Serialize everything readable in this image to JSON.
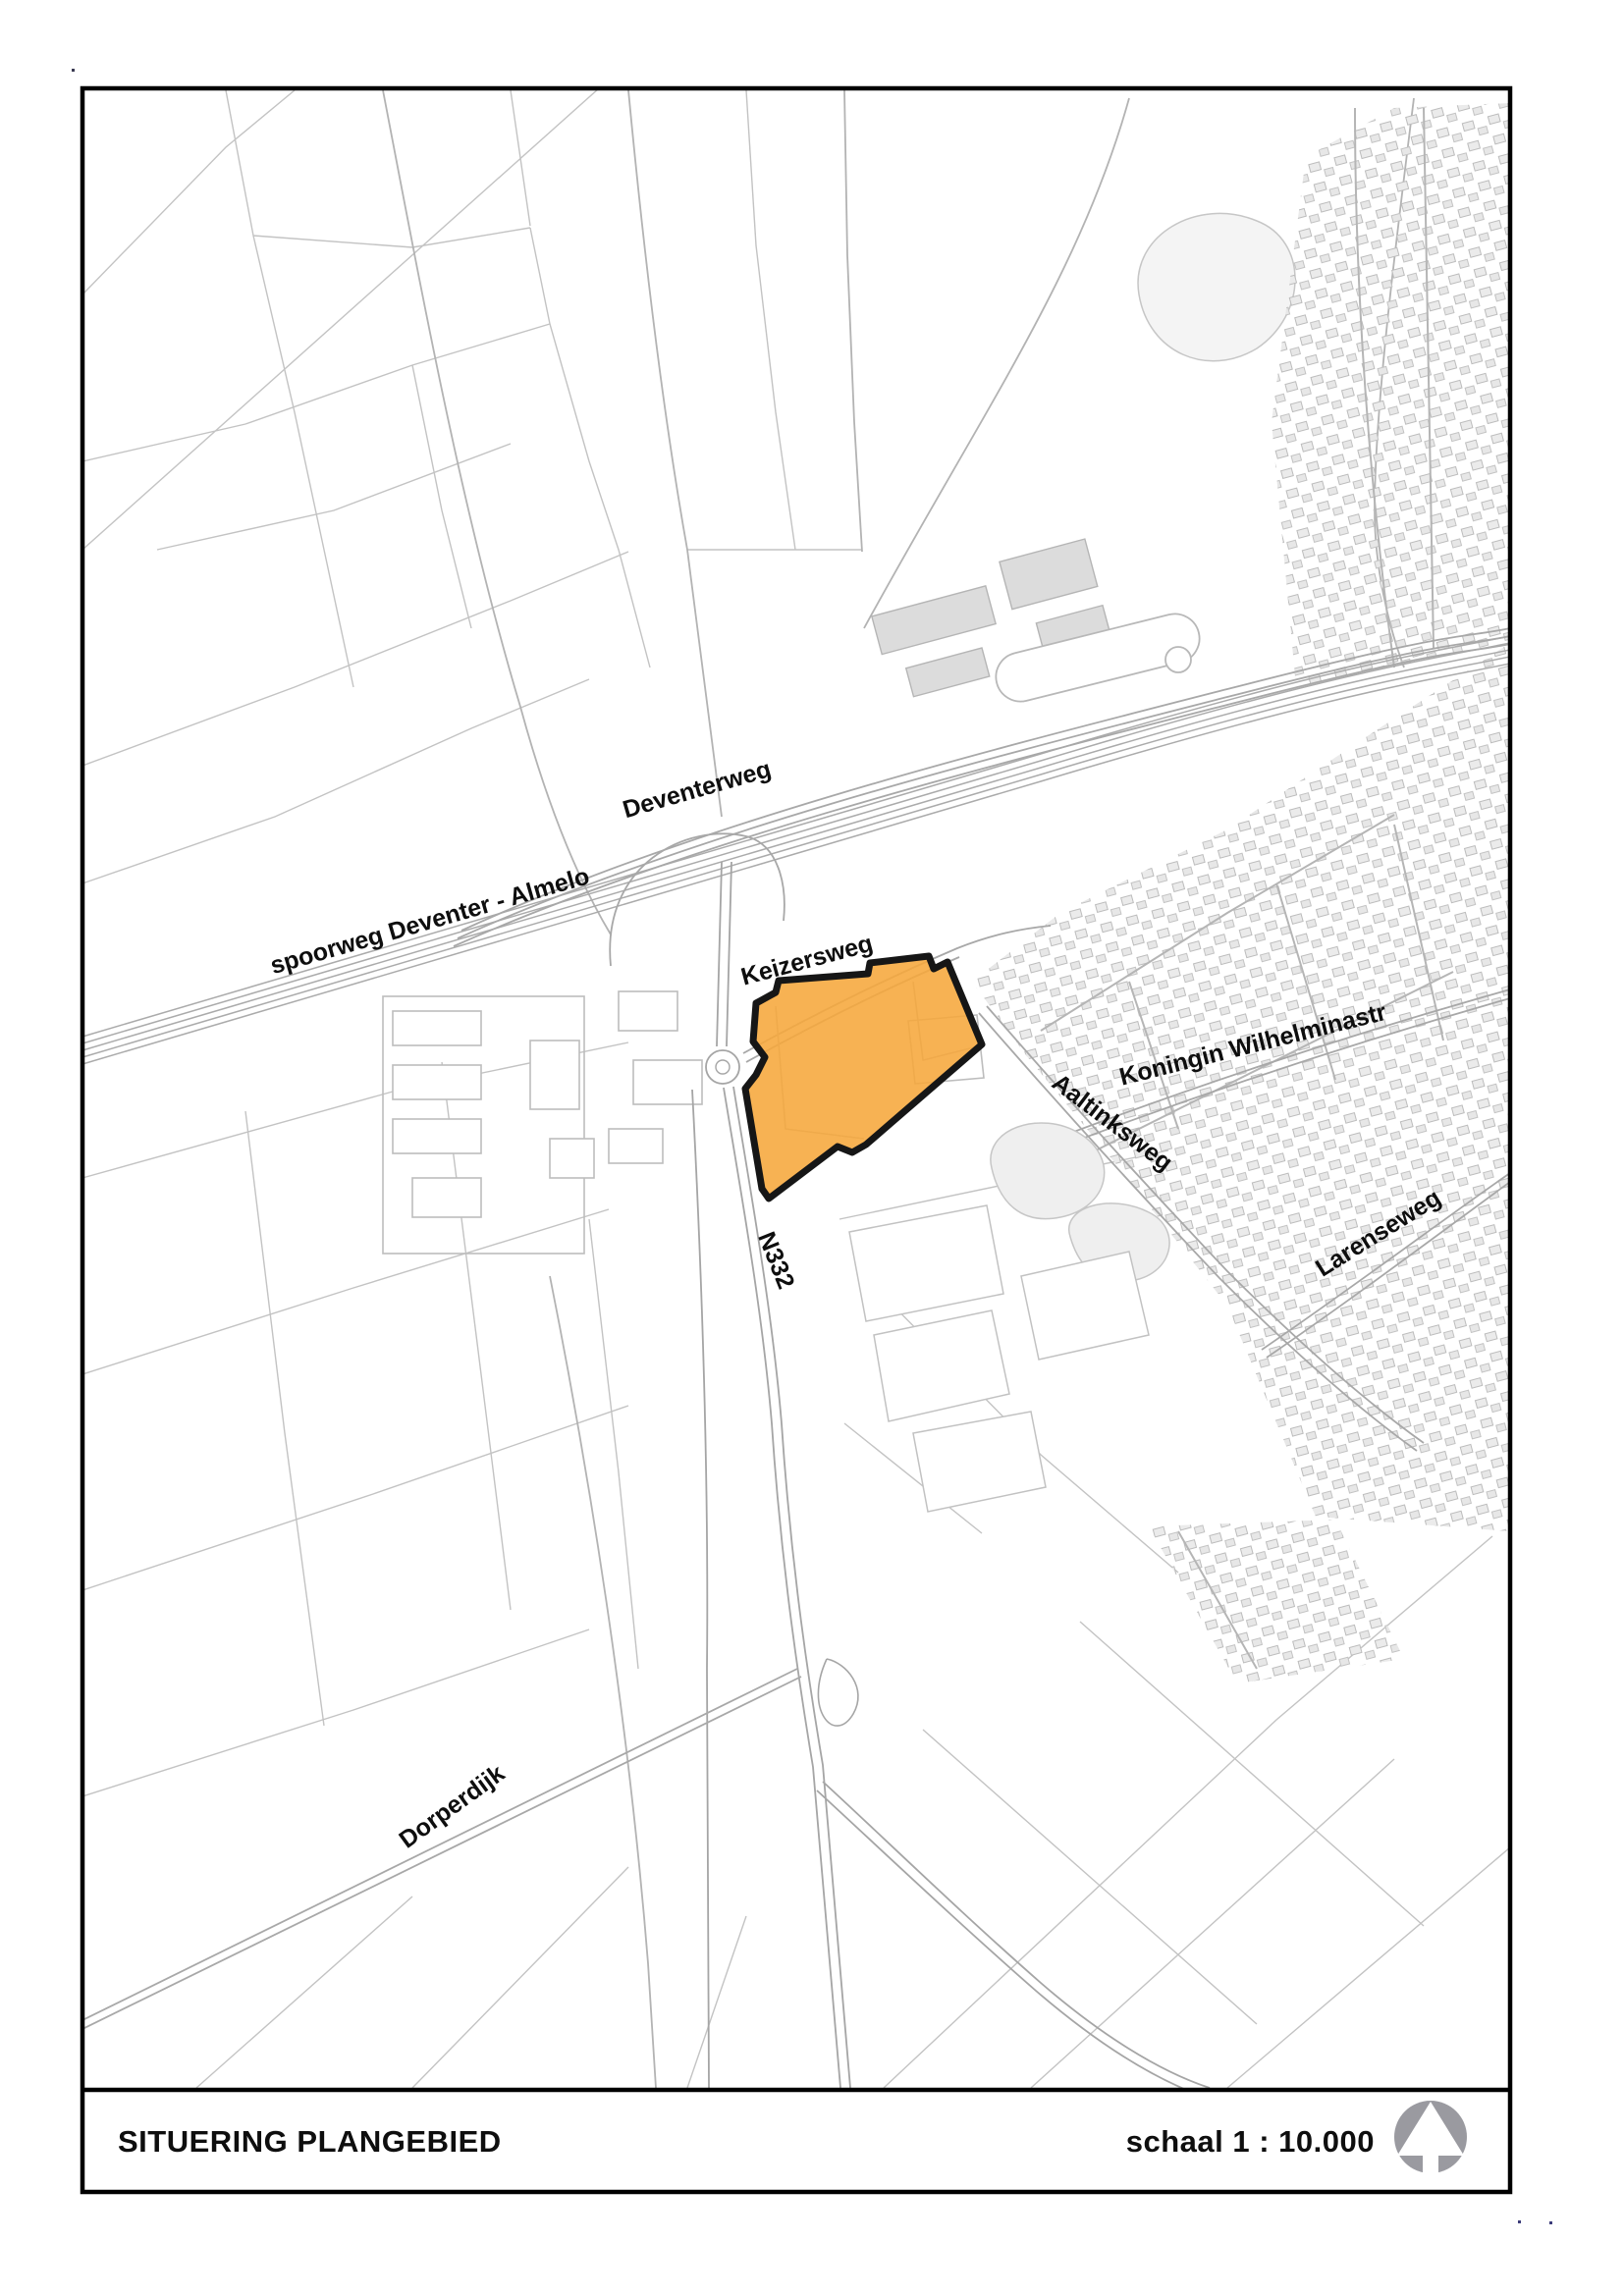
{
  "footer": {
    "title": "SITUERING PLANGEBIED",
    "scale_label": "schaal 1 : 10.000"
  },
  "map": {
    "labels": [
      {
        "id": "deventerweg",
        "text": "Deventerweg"
      },
      {
        "id": "spoorweg-deventer-almelo",
        "text": "spoorweg Deventer - Almelo"
      },
      {
        "id": "keizersweg",
        "text": "Keizersweg"
      },
      {
        "id": "koningin-wilhelminastr",
        "text": "Koningin Wilhelminastr"
      },
      {
        "id": "aaltinksweg",
        "text": "Aaltinksweg"
      },
      {
        "id": "larenseweg",
        "text": "Larenseweg"
      },
      {
        "id": "n332",
        "text": "N332"
      },
      {
        "id": "dorperdijk",
        "text": "Dorperdijk"
      }
    ],
    "plan_area": {
      "name": "plangebied",
      "fill": "#F6A73B",
      "outline": "#161616"
    },
    "compass": {
      "icon": "north-arrow-icon",
      "circle_color": "#9a9aa0",
      "arrow_color": "#ffffff"
    }
  }
}
